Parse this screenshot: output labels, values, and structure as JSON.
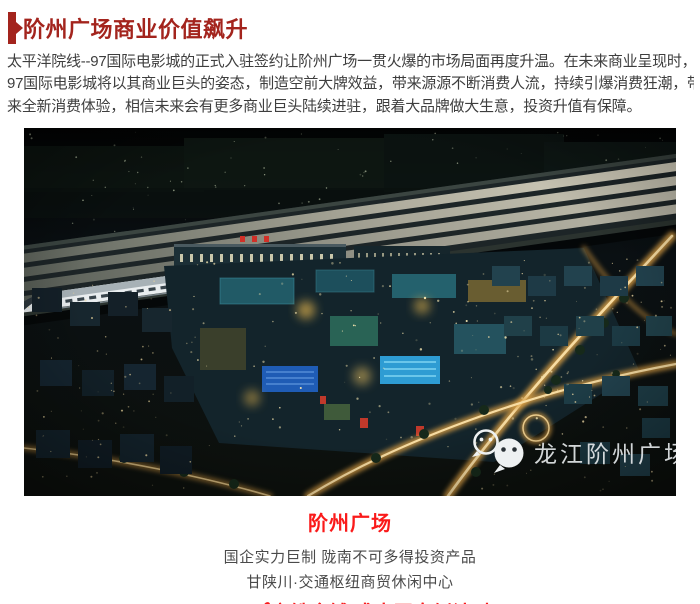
{
  "header": {
    "title": "阶州广场商业价值飙升",
    "accent_color": "#a3241d"
  },
  "article": {
    "paragraph_lines": [
      "太平洋院线--97国际电影城的正式入驻签约让阶州广场一贯火爆的市场局面再度升温。在未来商业呈现时，",
      "97国际电影城将以其商业巨头的姿态，制造空前大牌效益，带来源源不断消费人流，持续引爆消费狂潮，带",
      "来全新消费体验，相信未来会有更多商业巨头陆续进驻，跟着大品牌做大生意，投资升值有保障。"
    ],
    "text_color": "#3e3e3e"
  },
  "image": {
    "watermark_text": "龙江阶州广场",
    "watermark_icon": "wechat-icon"
  },
  "footer": {
    "plaza_title": "阶州广场",
    "line1": "国企实力巨制 陇南不可多得投资产品",
    "line2": "甘陕川·交通枢纽商贸休闲中心",
    "cta": "20-200㎡高铁金铺 盛大开盘倒计时！",
    "title_color": "#fa1a1a",
    "cta_color": "#f91c1c"
  }
}
